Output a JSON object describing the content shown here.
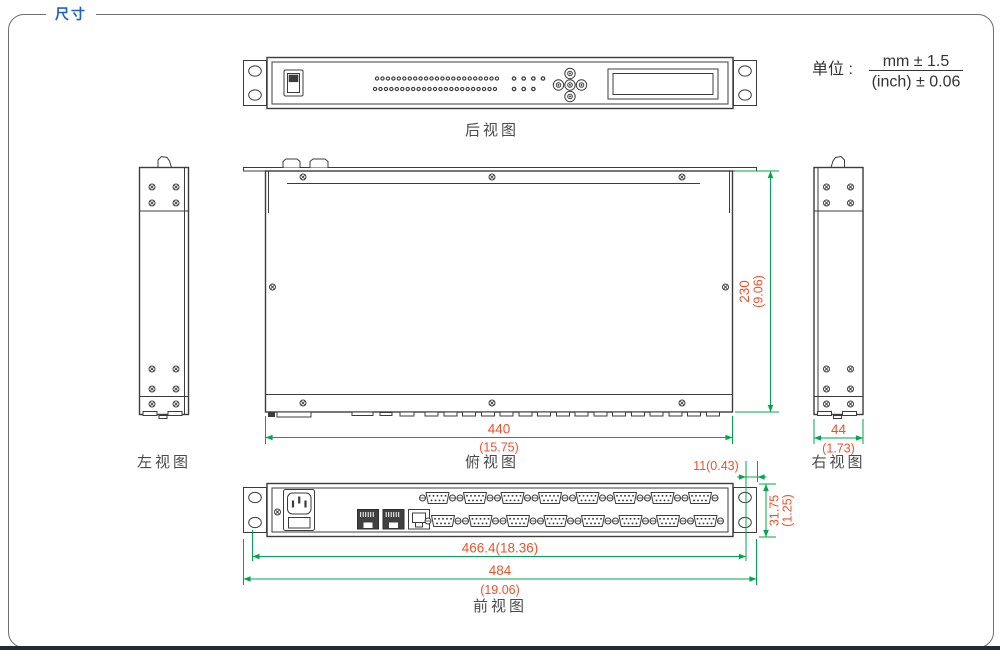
{
  "header": {
    "title": "尺寸"
  },
  "units": {
    "label": "单位 :",
    "mm_tolerance": "mm ± 1.5",
    "inch_tolerance": "(inch) ± 0.06"
  },
  "views": {
    "rear": {
      "label": "后视图"
    },
    "left": {
      "label": "左视图"
    },
    "top": {
      "label": "俯视图"
    },
    "right": {
      "label": "右视图"
    },
    "front": {
      "label": "前视图"
    }
  },
  "dimensions": {
    "depth": {
      "mm": "230",
      "inch": "(9.06)"
    },
    "body_width": {
      "mm": "440",
      "inch": "(15.75)"
    },
    "side_width": {
      "mm": "44",
      "inch": "(1.73)"
    },
    "ear_offset": {
      "value": "11(0.43)"
    },
    "panel_height": {
      "mm": "31.75",
      "inch": "(1.25)"
    },
    "mounting_width": {
      "value": "466.4(18.36)"
    },
    "total_width": {
      "mm": "484",
      "inch": "(19.06)"
    }
  },
  "colors": {
    "dimension_line": "#00A64F",
    "dimension_text": "#F0512B",
    "title_blue": "#2160C4",
    "drawing_line": "#3C3C3C",
    "footer_bar": "#222b38"
  }
}
